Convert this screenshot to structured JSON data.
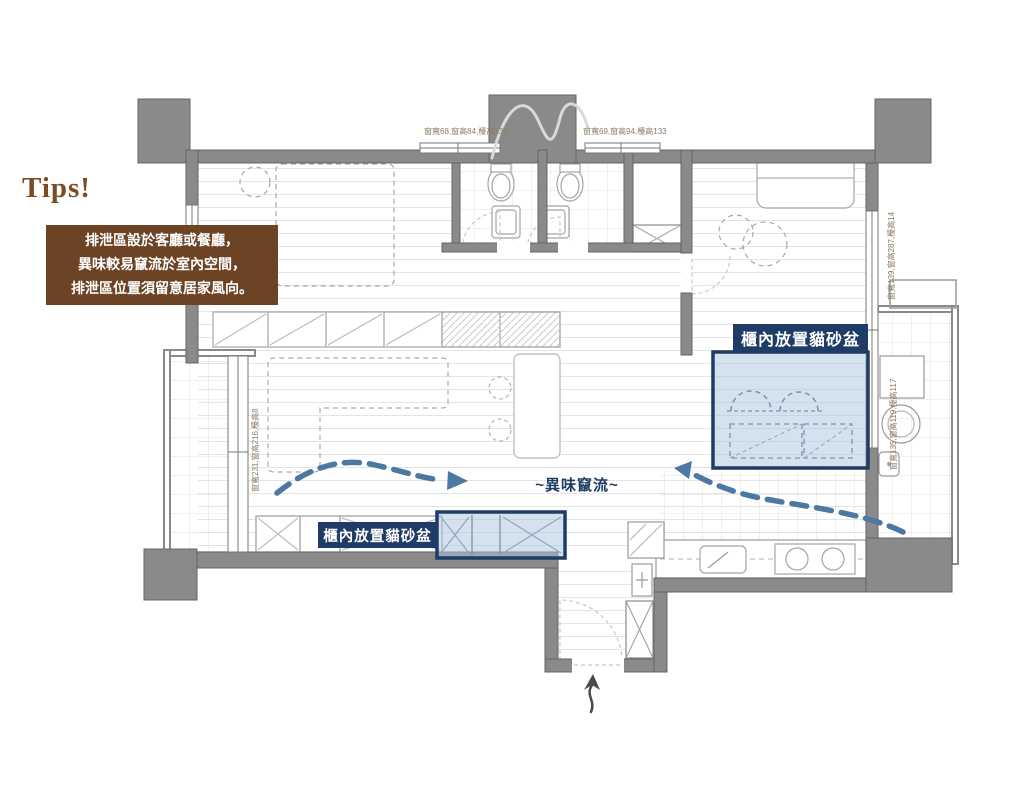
{
  "page": {
    "background": "#ffffff"
  },
  "tips": {
    "title": "Tips!",
    "line1": "排泄區設於客廳或餐廳，",
    "line2": "異味較易竄流於室內空間，",
    "line3": "排泄區位置須留意居家風向。"
  },
  "callouts": {
    "cabinet_litter_right": "櫃內放置貓砂盆",
    "cabinet_litter_bottom": "櫃內放置貓砂盆",
    "airflow": "~異味竄流~"
  },
  "window_annotations": {
    "top_left": "窗寬68,窗高84,檯高133",
    "top_right": "窗寬69,窗高94,檯高133",
    "right_upper": "窗寬139,窗高287,檯高14",
    "right_lower": "窗寬135,窗高119,檯高117",
    "left": "窗寬231,窗高216,檯高8"
  },
  "colors": {
    "wall_gray": "#8a8a8a",
    "tips_box_bg": "#6d4326",
    "tips_title_text": "#7b4b26",
    "navy": "#1e3c66",
    "highlight_blue": "#a9c4dd",
    "arrow_blue": "#4c79a3"
  }
}
